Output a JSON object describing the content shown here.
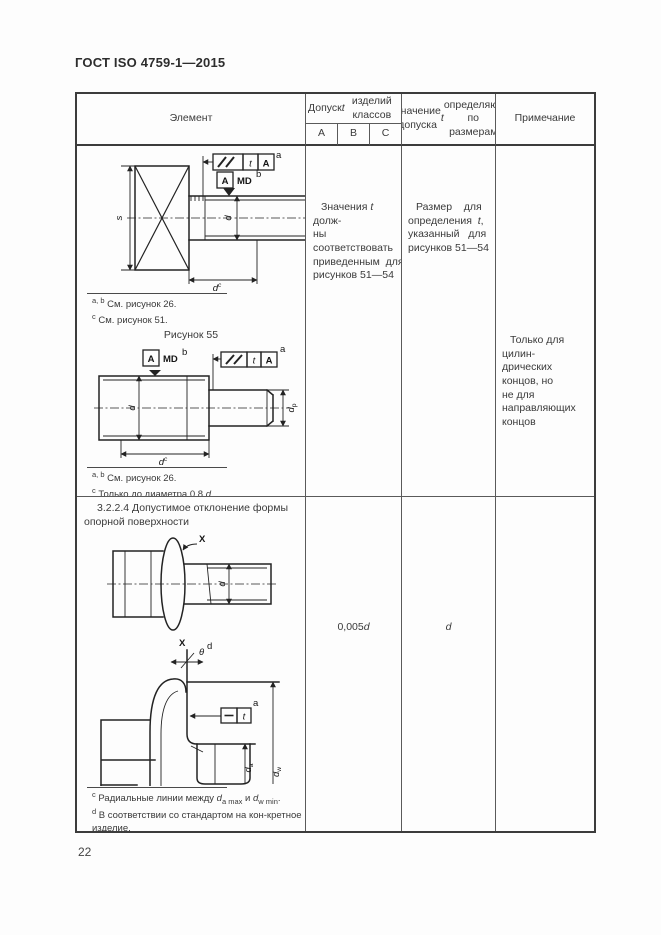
{
  "page": {
    "doc_code": "ГОСТ ISO 4759-1—2015",
    "page_number": "22"
  },
  "table": {
    "header": {
      "element": "Элемент",
      "tolerance_html": "Допуск <i>t</i> для изделий<br>классов точности",
      "classes": [
        "А",
        "В",
        "С"
      ],
      "value_html": "Значение допуска<br><i>t</i> определяют по<br>размерам",
      "note": "Примечание"
    },
    "row1": {
      "tolerance_html": "Значения <i>t</i> долж-<br>ны соответствовать<br>приведенным&nbsp;&nbsp;для<br>рисунков 51—54",
      "value_html": "Размер&nbsp;&nbsp;&nbsp;&nbsp;для<br>определения&nbsp;&nbsp;<i>t</i>,<br>указанный&nbsp;&nbsp;&nbsp;для<br>рисунков 51—54",
      "note_html": "Только для цилин-<br>дрических концов, но<br>не для направляющих<br>концов"
    },
    "row2": {
      "section_text": "3.2.2.4 Допустимое  отклонение  формы опорной поверхности",
      "tolerance_html": "0,005<i>d</i>",
      "value_html": "<i>d</i>"
    }
  },
  "figures": {
    "fig55": {
      "caption": "Рисунок 55",
      "footnotes_html": "<sup>а, b</sup> См. рисунок 26.<br><sup>с</sup> См. рисунок 51."
    },
    "fig56": {
      "caption": "Рисунок 56",
      "footnotes_html": "<sup>а, b</sup> См. рисунок 26.<br><sup>с</sup> Только до диаметра 0,8 <i>d</i><sub>р</sub>."
    },
    "fig57": {
      "caption": "Рисунок 57",
      "footnotes_html": "<sup>с</sup> Радиальные линии между <i>d</i><sub>а max</sub> и <i>d</i><sub>w min</sub>.<br><sup>d</sup> В соответствии со стандартом на кон-кретное изделие."
    }
  },
  "sym": {
    "A": "A",
    "MD": "MD",
    "t": "t",
    "d": "d",
    "s": "s",
    "p": "p",
    "X": "X",
    "theta": "θ",
    "sup_a": "a",
    "sup_b": "b",
    "sup_c": "c",
    "sup_d": "d",
    "sub_a": "а",
    "sub_w": "w"
  }
}
